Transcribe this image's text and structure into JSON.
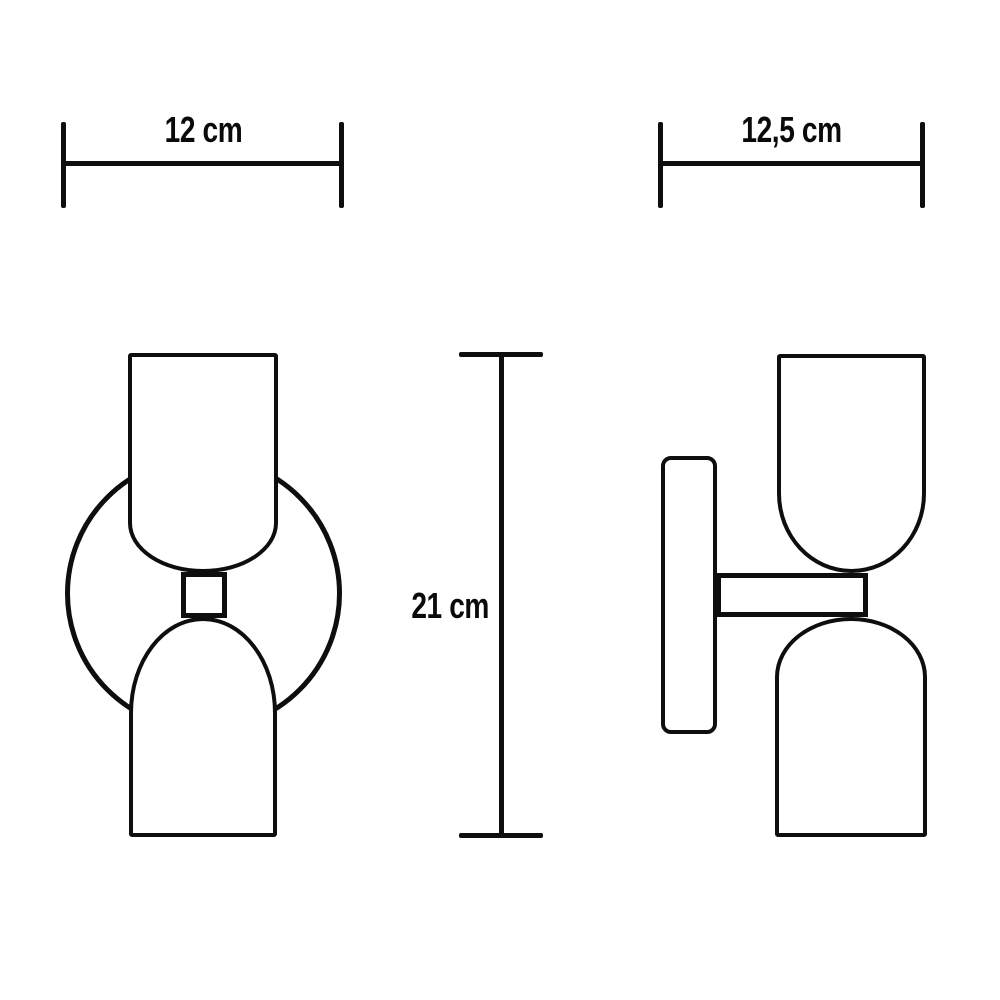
{
  "canvas": {
    "background": "#ffffff",
    "ink": "#0e0e0e",
    "text_color": "#0a0a0a"
  },
  "drawing": {
    "kind": "technical-dimension-drawing",
    "views": [
      "front",
      "side"
    ]
  },
  "dimensions": [
    {
      "id": "front-width",
      "label": "12 cm",
      "value": 12,
      "unit": "cm",
      "orientation": "horizontal"
    },
    {
      "id": "side-depth",
      "label": "12,5 cm",
      "value": 12.5,
      "unit": "cm",
      "orientation": "horizontal"
    },
    {
      "id": "height",
      "label": "21 cm",
      "value": 21,
      "unit": "cm",
      "orientation": "vertical"
    }
  ]
}
